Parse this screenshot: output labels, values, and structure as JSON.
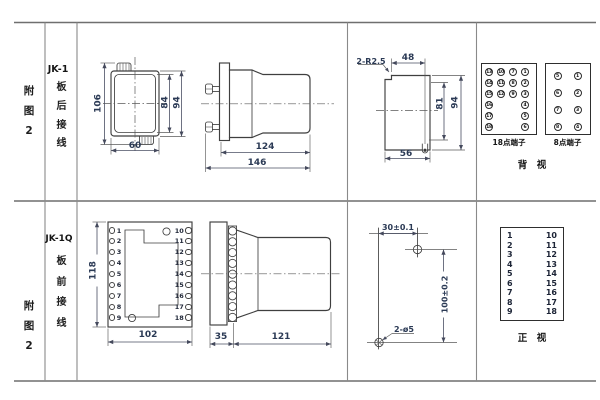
{
  "palette": {
    "line": "#3f3f3f",
    "dim_text": "#2b3a55",
    "text": "#1a1a1a",
    "grid": "#6f6f6f",
    "bg": "#ffffff"
  },
  "row1": {
    "fig_label": "附图2",
    "model": "JK-1",
    "wiring": "板后接线",
    "rear_case": {
      "height_total": "106",
      "height_inner": "84",
      "height_outer": "94",
      "width": "60"
    },
    "side_view": {
      "depth_body": "124",
      "depth_total": "146"
    },
    "cutout": {
      "corner_note": "2-R2.5",
      "width_top": "48",
      "height_inner": "81",
      "height_outer": "94",
      "width_bottom": "56"
    },
    "rear_terms": {
      "t18": [
        "13",
        "10",
        "7",
        "1",
        "14",
        "11",
        "8",
        "2",
        "15",
        "12",
        "9",
        "3",
        "16",
        "4",
        "17",
        "5",
        "18",
        "6"
      ],
      "t18_caption": "18点端子",
      "t8": [
        "5",
        "1",
        "6",
        "2",
        "7",
        "3",
        "8",
        "4"
      ],
      "t8_caption": "8点端子",
      "view_caption": "背　视"
    }
  },
  "row2": {
    "fig_label": "附图2",
    "model": "JK-1Q",
    "wiring": "板前接线",
    "front_face": {
      "height": "118",
      "width": "102",
      "left_terms": [
        "1",
        "2",
        "3",
        "4",
        "5",
        "6",
        "7",
        "8",
        "9"
      ],
      "right_terms": [
        "10",
        "11",
        "12",
        "13",
        "14",
        "15",
        "16",
        "17",
        "18"
      ]
    },
    "side_view": {
      "flange_depth": "35",
      "body_depth": "121"
    },
    "drill": {
      "hole_spacing_h": "30±0.1",
      "hole_spacing_v": "100±0.2",
      "holes": "2-ø5"
    },
    "front_terms": {
      "left": [
        "1",
        "2",
        "3",
        "4",
        "5",
        "6",
        "7",
        "8",
        "9"
      ],
      "right": [
        "10",
        "11",
        "12",
        "13",
        "14",
        "15",
        "16",
        "17",
        "18"
      ],
      "view_caption": "正　视"
    }
  }
}
